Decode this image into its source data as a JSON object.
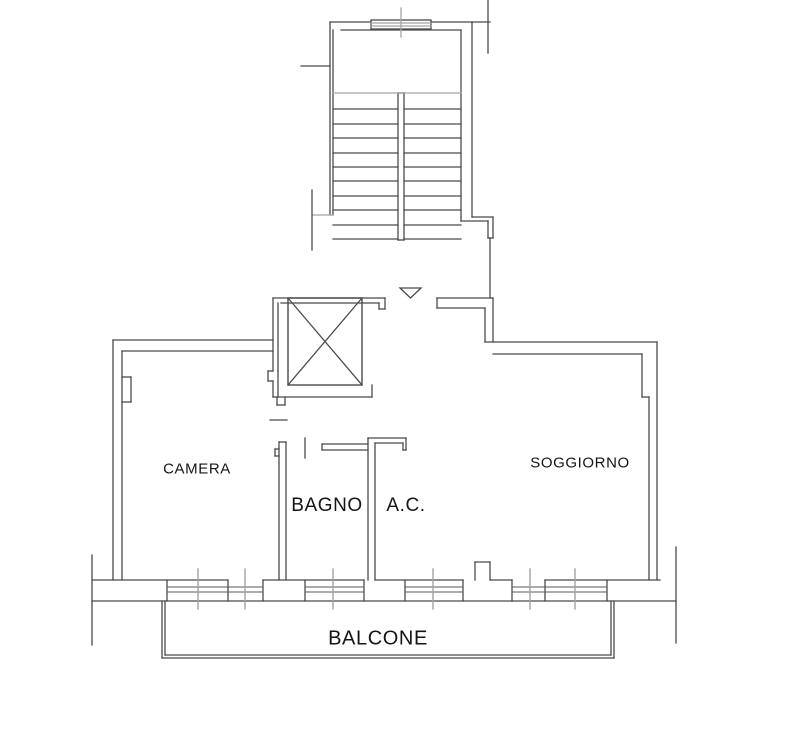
{
  "drawing": {
    "canvas": {
      "width": 795,
      "height": 737,
      "background": "#ffffff"
    },
    "colors": {
      "wall": "#4a4a4a",
      "light": "#a3a3a3",
      "glass": "#5a5a5a",
      "text": "#151515"
    },
    "rooms": [
      {
        "id": "camera",
        "label": "CAMERA",
        "x": 197,
        "y": 469,
        "size": 15
      },
      {
        "id": "bagno",
        "label": "BAGNO",
        "x": 327,
        "y": 506,
        "size": 19
      },
      {
        "id": "ac",
        "label": "A.C.",
        "x": 406,
        "y": 506,
        "size": 19
      },
      {
        "id": "soggiorno",
        "label": "SOGGIORNO",
        "x": 580,
        "y": 463,
        "size": 15
      },
      {
        "id": "balcone",
        "label": "BALCONE",
        "x": 378,
        "y": 639,
        "size": 20
      }
    ],
    "entrance_marker": {
      "points": "400,288 421,288 410.5,298"
    },
    "elevator_shaft": {
      "rect": [
        288,
        298,
        74,
        87
      ]
    },
    "stair_treads": {
      "left": [
        333,
        398
      ],
      "right": [
        404,
        461
      ],
      "ys": [
        109,
        124,
        138,
        153,
        167,
        181,
        196,
        210,
        225,
        239
      ]
    },
    "window_glazing": {
      "y1": 587,
      "y2": 592,
      "spans": [
        [
          167,
          263
        ],
        [
          305,
          364
        ],
        [
          405,
          463
        ],
        [
          512,
          607
        ]
      ]
    },
    "sill_ticks": {
      "y1": 569,
      "y2": 609,
      "xs": [
        198,
        245,
        333,
        433,
        530,
        575
      ]
    },
    "lines": [
      [
        "l",
        330,
        22,
        330,
        215
      ],
      [
        "l",
        333,
        30,
        333,
        215
      ],
      [
        "l",
        312,
        215,
        333,
        215,
        "lt"
      ],
      [
        "l",
        312,
        190,
        312,
        250
      ],
      [
        "l",
        301,
        66,
        330,
        66
      ],
      [
        "l",
        330,
        22,
        371,
        22
      ],
      [
        "l",
        431,
        22,
        490,
        22
      ],
      [
        "l",
        341,
        30,
        461,
        30
      ],
      [
        "r",
        371,
        20,
        60,
        9
      ],
      [
        "l",
        371,
        23,
        431,
        23,
        "lt"
      ],
      [
        "l",
        371,
        26,
        431,
        26,
        "lt"
      ],
      [
        "l",
        401,
        8,
        401,
        37,
        "lt"
      ],
      [
        "l",
        488,
        0,
        488,
        53
      ],
      [
        "l",
        461,
        30,
        461,
        217
      ],
      [
        "l",
        472,
        22,
        472,
        217
      ],
      [
        "l",
        472,
        217,
        493,
        217
      ],
      [
        "l",
        493,
        217,
        493,
        238
      ],
      [
        "l",
        461,
        217,
        461,
        221
      ],
      [
        "l",
        461,
        221,
        488,
        221
      ],
      [
        "l",
        488,
        221,
        488,
        238
      ],
      [
        "l",
        488,
        238,
        493,
        238
      ],
      [
        "l",
        490,
        238,
        490,
        298
      ],
      [
        "l",
        398,
        93,
        398,
        240
      ],
      [
        "l",
        404,
        93,
        404,
        240
      ],
      [
        "l",
        398,
        93,
        404,
        93
      ],
      [
        "l",
        398,
        240,
        404,
        240
      ],
      [
        "l",
        333,
        93,
        461,
        93,
        "lt"
      ],
      [
        "l",
        273,
        298,
        385,
        298
      ],
      [
        "l",
        281,
        303,
        379,
        303
      ],
      [
        "l",
        385,
        298,
        385,
        309
      ],
      [
        "l",
        379,
        303,
        379,
        309
      ],
      [
        "l",
        379,
        309,
        385,
        309
      ],
      [
        "l",
        273,
        298,
        273,
        371
      ],
      [
        "l",
        278,
        303,
        278,
        371
      ],
      [
        "l",
        273,
        371,
        268,
        371
      ],
      [
        "l",
        268,
        371,
        268,
        381
      ],
      [
        "l",
        268,
        381,
        273,
        381
      ],
      [
        "l",
        273,
        381,
        273,
        397
      ],
      [
        "l",
        278,
        371,
        278,
        397
      ],
      [
        "l",
        288,
        298,
        362,
        385
      ],
      [
        "l",
        362,
        298,
        288,
        385
      ],
      [
        "l",
        273,
        397,
        372,
        397
      ],
      [
        "l",
        372,
        385,
        372,
        397
      ],
      [
        "l",
        277,
        397,
        277,
        405
      ],
      [
        "l",
        285,
        397,
        285,
        405
      ],
      [
        "l",
        277,
        405,
        285,
        405
      ],
      [
        "l",
        270,
        420,
        287,
        420
      ],
      [
        "l",
        113,
        340,
        273,
        340
      ],
      [
        "l",
        122,
        351,
        273,
        351
      ],
      [
        "l",
        113,
        340,
        113,
        580
      ],
      [
        "l",
        122,
        351,
        122,
        580
      ],
      [
        "l",
        122,
        377,
        131,
        377
      ],
      [
        "l",
        131,
        377,
        131,
        402
      ],
      [
        "l",
        131,
        402,
        122,
        402
      ],
      [
        "l",
        279,
        442,
        279,
        580
      ],
      [
        "l",
        286,
        442,
        286,
        580
      ],
      [
        "l",
        279,
        442,
        286,
        442
      ],
      [
        "l",
        279,
        449,
        275,
        449
      ],
      [
        "l",
        275,
        449,
        275,
        456
      ],
      [
        "l",
        275,
        456,
        279,
        456
      ],
      [
        "l",
        305,
        438,
        305,
        458
      ],
      [
        "l",
        322,
        444,
        368,
        444
      ],
      [
        "l",
        322,
        450,
        368,
        450
      ],
      [
        "l",
        322,
        444,
        322,
        450
      ],
      [
        "l",
        368,
        438,
        368,
        580
      ],
      [
        "l",
        375,
        443,
        375,
        580
      ],
      [
        "l",
        368,
        438,
        406,
        438
      ],
      [
        "l",
        375,
        443,
        403,
        443
      ],
      [
        "l",
        406,
        438,
        406,
        450
      ],
      [
        "l",
        403,
        443,
        403,
        450
      ],
      [
        "l",
        403,
        450,
        406,
        450
      ],
      [
        "l",
        437,
        298,
        493,
        298
      ],
      [
        "l",
        437,
        308,
        485,
        308
      ],
      [
        "l",
        437,
        298,
        437,
        308
      ],
      [
        "l",
        485,
        308,
        485,
        342
      ],
      [
        "l",
        493,
        298,
        493,
        342
      ],
      [
        "l",
        485,
        342,
        657,
        342
      ],
      [
        "l",
        493,
        354,
        642,
        354
      ],
      [
        "l",
        657,
        342,
        657,
        580
      ],
      [
        "l",
        642,
        354,
        642,
        397
      ],
      [
        "l",
        642,
        397,
        649,
        397
      ],
      [
        "l",
        649,
        397,
        649,
        580
      ],
      [
        "l",
        92,
        601,
        676,
        601
      ],
      [
        "l",
        92,
        580,
        228,
        580
      ],
      [
        "l",
        263,
        580,
        364,
        580
      ],
      [
        "l",
        375,
        580,
        463,
        580
      ],
      [
        "l",
        490,
        580,
        512,
        580
      ],
      [
        "l",
        545,
        580,
        660,
        580
      ],
      [
        "l",
        475,
        562,
        490,
        562
      ],
      [
        "l",
        475,
        562,
        475,
        580
      ],
      [
        "l",
        490,
        562,
        490,
        580
      ],
      [
        "l",
        167,
        580,
        167,
        601
      ],
      [
        "l",
        228,
        580,
        228,
        601
      ],
      [
        "l",
        263,
        580,
        263,
        601
      ],
      [
        "l",
        305,
        580,
        305,
        601
      ],
      [
        "l",
        364,
        580,
        364,
        601
      ],
      [
        "l",
        405,
        580,
        405,
        601
      ],
      [
        "l",
        463,
        580,
        463,
        601
      ],
      [
        "l",
        512,
        580,
        512,
        601
      ],
      [
        "l",
        545,
        580,
        545,
        601
      ],
      [
        "l",
        607,
        580,
        607,
        601
      ],
      [
        "l",
        165,
        601,
        165,
        655
      ],
      [
        "l",
        165,
        655,
        611,
        655
      ],
      [
        "l",
        611,
        655,
        611,
        601
      ],
      [
        "l",
        162,
        601,
        162,
        658
      ],
      [
        "l",
        162,
        658,
        614,
        658
      ],
      [
        "l",
        614,
        658,
        614,
        601
      ],
      [
        "l",
        92,
        555,
        92,
        645
      ],
      [
        "l",
        676,
        547,
        676,
        643
      ]
    ]
  }
}
